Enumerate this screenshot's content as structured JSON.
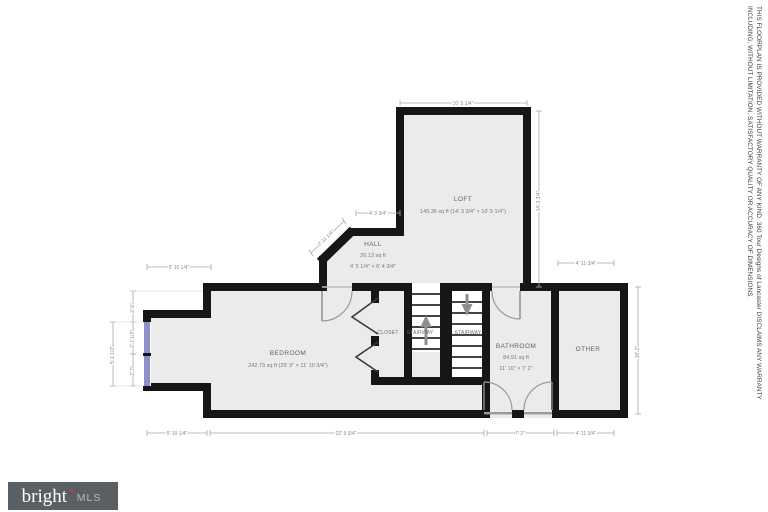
{
  "branding": {
    "logo_text": "bright",
    "logo_star": "✶",
    "logo_suffix": "MLS"
  },
  "disclaimer": {
    "line1": "THIS FLOORPLAN IS PROVIDED WITHOUT WARRANTY OF ANY KIND. 360 Tour Designs of Lancaster DISCLAIMS ANY WARRANTY",
    "line2": "INCLUDING, WITHOUT LIMITATION, SATISFACTORY QUALITY OR ACCURACY OF DIMENSIONS."
  },
  "rooms": {
    "loft": {
      "name": "LOFT",
      "area": "149.36 sq ft (14' 3 3/4\" × 10' 5 1/4\")"
    },
    "hall": {
      "name": "HALL",
      "area": "26.13 sq ft",
      "dims": "4' 5 1/4\" × 6' 4 3/4\""
    },
    "bedroom": {
      "name": "BEDROOM",
      "area": "242.73 sq ft (29' 9\" × 11' 10 3/4\")"
    },
    "bathroom": {
      "name": "BATHROOM",
      "area": "84.91 sq ft",
      "dims": "11' 10\" × 7' 2\""
    },
    "other": {
      "name": "OTHER"
    },
    "closet": {
      "name": "CLOSET"
    },
    "stairway_up": {
      "name": "STAIRWAY"
    },
    "stairway_down": {
      "name": "STAIRWAY"
    }
  },
  "dims": {
    "loft_top": "10' 5 1/4\"",
    "loft_right": "14' 3 3/4\"",
    "hall_top": "4' 3 3/4\"",
    "diagonal": "2' 11 1/4\"",
    "bump_top": "5' 10 1/4\"",
    "other_top": "4' 11 3/4\"",
    "right_side": "10' 2\"",
    "left_seg1": "2' 6\"",
    "left_seg2": "2' 7 1/2\"",
    "left_seg3": "2' 7\"",
    "left_overall": "5' 1 1/2\"",
    "bottom_1": "5' 10 1/4\"",
    "bottom_2": "22' 9 3/4\"",
    "bottom_3": "7' 2\"",
    "bottom_4": "4' 11 3/4\""
  },
  "colors": {
    "wall": "#161616",
    "room_fill": "#ebebeb",
    "window": "#8a90c8",
    "logo_background": "#5a5f63",
    "logo_accent": "#d93a2b"
  }
}
